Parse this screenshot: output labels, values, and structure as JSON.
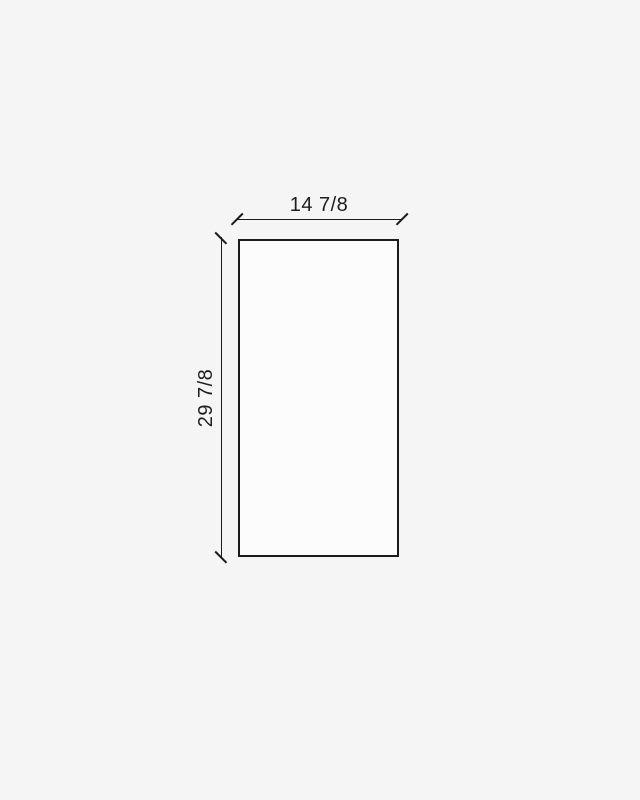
{
  "drawing": {
    "shape": "rectangle",
    "width_label": "14 7/8",
    "height_label": "29 7/8"
  },
  "colors": {
    "background": "#f5f5f5",
    "line": "#1b1b1b",
    "text": "#1e1e1e",
    "panel_fill": "#fcfcfc"
  }
}
